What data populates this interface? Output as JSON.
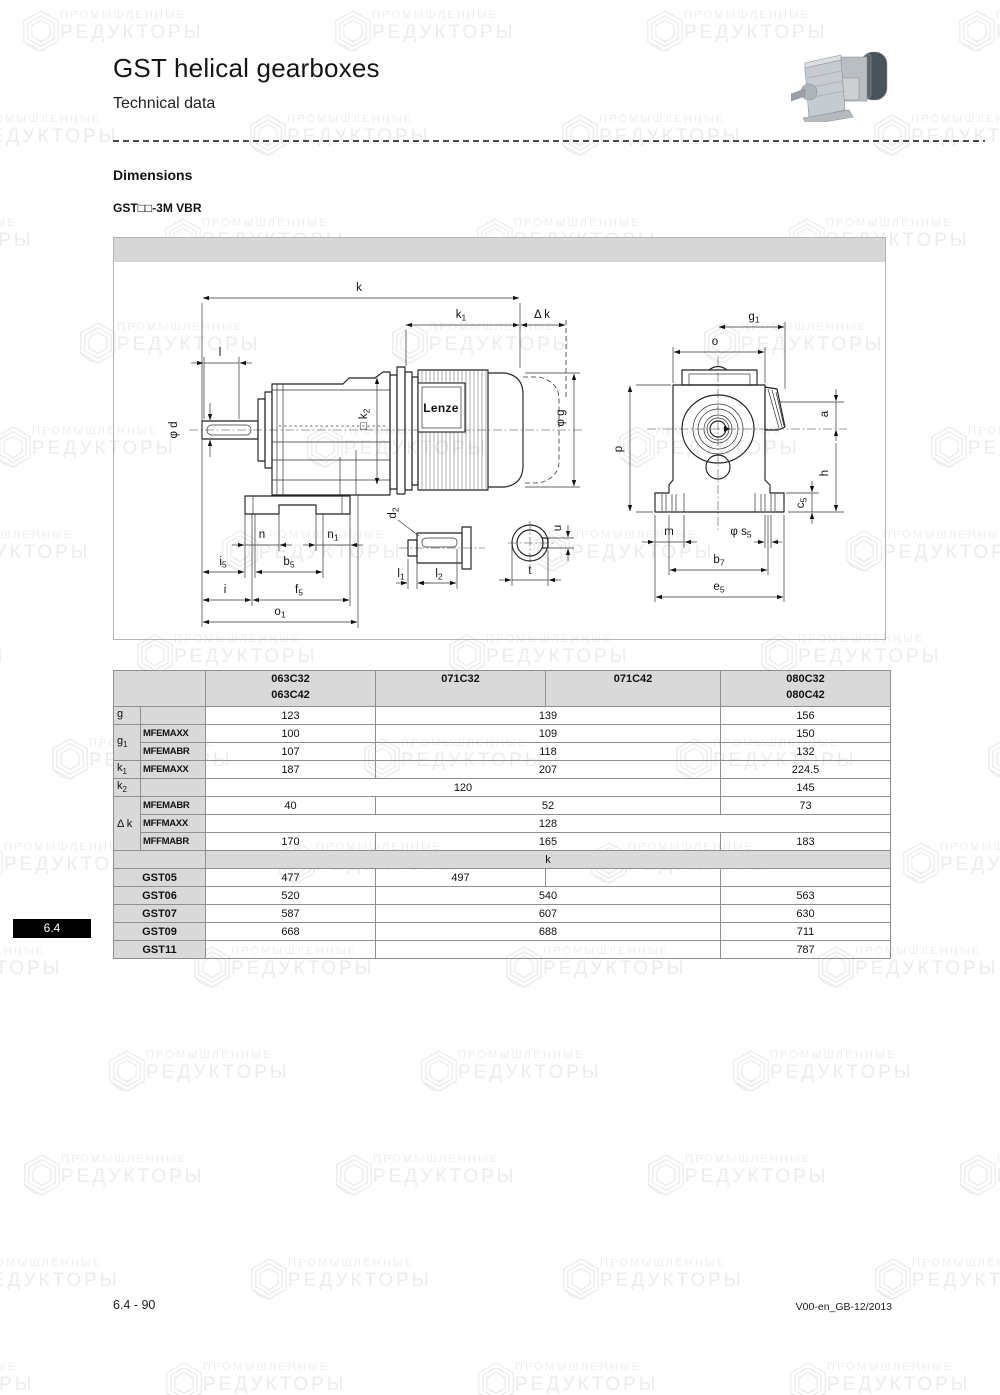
{
  "page": {
    "title": "GST helical gearboxes",
    "subtitle": "Technical data",
    "section": "Dimensions",
    "variant": "GST□□-3M VBR",
    "tab": "6.4",
    "footer_left": "6.4 - 90",
    "footer_right": "V00-en_GB-12/2013"
  },
  "watermark": {
    "line1": "ПРОМЫШЛЕННЫЕ",
    "line2": "РЕДУКТОРЫ"
  },
  "drawing": {
    "brand": "Lenze",
    "labels": {
      "k": {
        "m": "k",
        "s": ""
      },
      "k1": {
        "m": "k",
        "s": "1"
      },
      "dk": {
        "m": "Δ k",
        "s": ""
      },
      "l": {
        "m": "l",
        "s": ""
      },
      "phi_d": {
        "m": "φ d",
        "s": ""
      },
      "k2": {
        "m": "□ k",
        "s": "2"
      },
      "phi_g": {
        "m": "φ g",
        "s": ""
      },
      "n": {
        "m": "n",
        "s": ""
      },
      "n1": {
        "m": "n",
        "s": "1"
      },
      "i5": {
        "m": "i",
        "s": "5"
      },
      "b5": {
        "m": "b",
        "s": "5"
      },
      "i": {
        "m": "i",
        "s": ""
      },
      "f5": {
        "m": "f",
        "s": "5"
      },
      "o1": {
        "m": "o",
        "s": "1"
      },
      "d2": {
        "m": "d",
        "s": "2"
      },
      "l1": {
        "m": "l",
        "s": "1"
      },
      "l2": {
        "m": "l",
        "s": "2"
      },
      "u": {
        "m": "u",
        "s": ""
      },
      "t": {
        "m": "t",
        "s": ""
      },
      "g1": {
        "m": "g",
        "s": "1"
      },
      "o": {
        "m": "o",
        "s": ""
      },
      "p": {
        "m": "p",
        "s": ""
      },
      "a": {
        "m": "a",
        "s": ""
      },
      "h": {
        "m": "h",
        "s": ""
      },
      "c5": {
        "m": "c",
        "s": "5"
      },
      "m": {
        "m": "m",
        "s": ""
      },
      "s5": {
        "m": "φ s",
        "s": "5"
      },
      "b7": {
        "m": "b",
        "s": "7"
      },
      "e5": {
        "m": "e",
        "s": "5"
      }
    }
  },
  "table": {
    "headers": [
      {
        "l1": "063C32",
        "l2": "063C42"
      },
      {
        "l1": "071C32",
        "l2": ""
      },
      {
        "l1": "071C42",
        "l2": ""
      },
      {
        "l1": "080C32",
        "l2": "080C42"
      }
    ],
    "row_labels": {
      "g": {
        "m": "g",
        "s": ""
      },
      "g1": {
        "m": "g",
        "s": "1"
      },
      "k1": {
        "m": "k",
        "s": "1"
      },
      "k2": {
        "m": "k",
        "s": "2"
      },
      "dk": {
        "m": "Δ k",
        "s": ""
      }
    },
    "sub_labels": {
      "mfemaxx": "MFEMAXX",
      "mfemabr": "MFEMABR",
      "mffmaxx": "MFFMAXX",
      "mffmabr": "MFFMABR"
    },
    "k_header": "k",
    "rows": {
      "g": [
        "123",
        "139",
        "156"
      ],
      "g1_mfemaxx": [
        "100",
        "109",
        "150"
      ],
      "g1_mfemabr": [
        "107",
        "118",
        "132"
      ],
      "k1_mfemaxx": [
        "187",
        "207",
        "224.5"
      ],
      "k2": [
        "120",
        "145"
      ],
      "dk_mfemabr": [
        "40",
        "52",
        "73"
      ],
      "dk_mffmaxx": [
        "128"
      ],
      "dk_mffmabr": [
        "170",
        "165",
        "183"
      ],
      "gst05": {
        "label": "GST05",
        "vals": [
          "477",
          "497",
          "",
          ""
        ]
      },
      "gst06": {
        "label": "GST06",
        "vals": [
          "520",
          "540",
          "563"
        ]
      },
      "gst07": {
        "label": "GST07",
        "vals": [
          "587",
          "607",
          "630"
        ]
      },
      "gst09": {
        "label": "GST09",
        "vals": [
          "668",
          "688",
          "711"
        ]
      },
      "gst11": {
        "label": "GST11",
        "vals": [
          "",
          "",
          "787"
        ]
      }
    }
  },
  "colors": {
    "table_header_bg": "#d9d9d9",
    "tab_bg": "#000000",
    "drawing_strip": "#d7d7d7",
    "watermark": "#ececec"
  }
}
